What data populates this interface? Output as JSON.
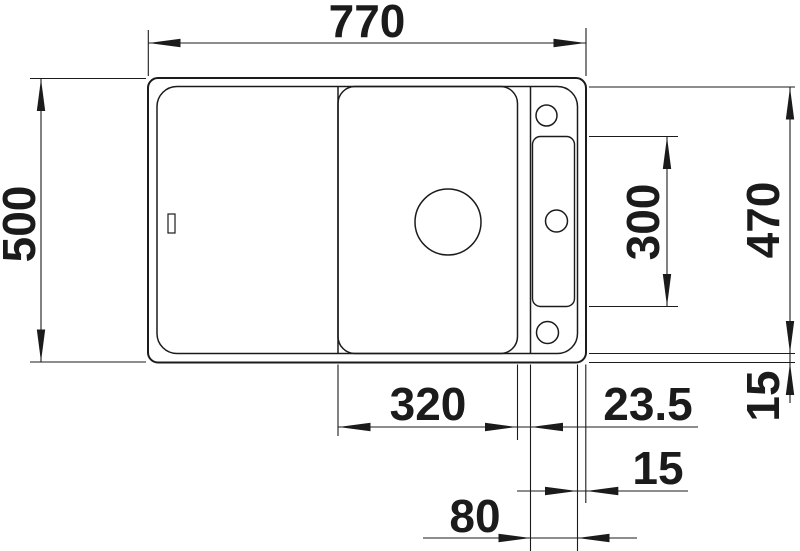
{
  "drawing": {
    "type": "technical-dimension-drawing",
    "subject": "kitchen sink top view with bowl, drainboard, tap ledge and accessory rail",
    "unit_system": "mm",
    "line_color": "#1b1b1b",
    "background_color": "#ffffff"
  },
  "labels": {
    "total_width": "770",
    "total_depth": "500",
    "cutout_depth": "470",
    "rail_length": "300",
    "bowl_width": "320",
    "bowl_to_divider_offset": "23.5",
    "rim_vertical": "15",
    "rim_horizontal": "15",
    "ledge_width": "80"
  }
}
